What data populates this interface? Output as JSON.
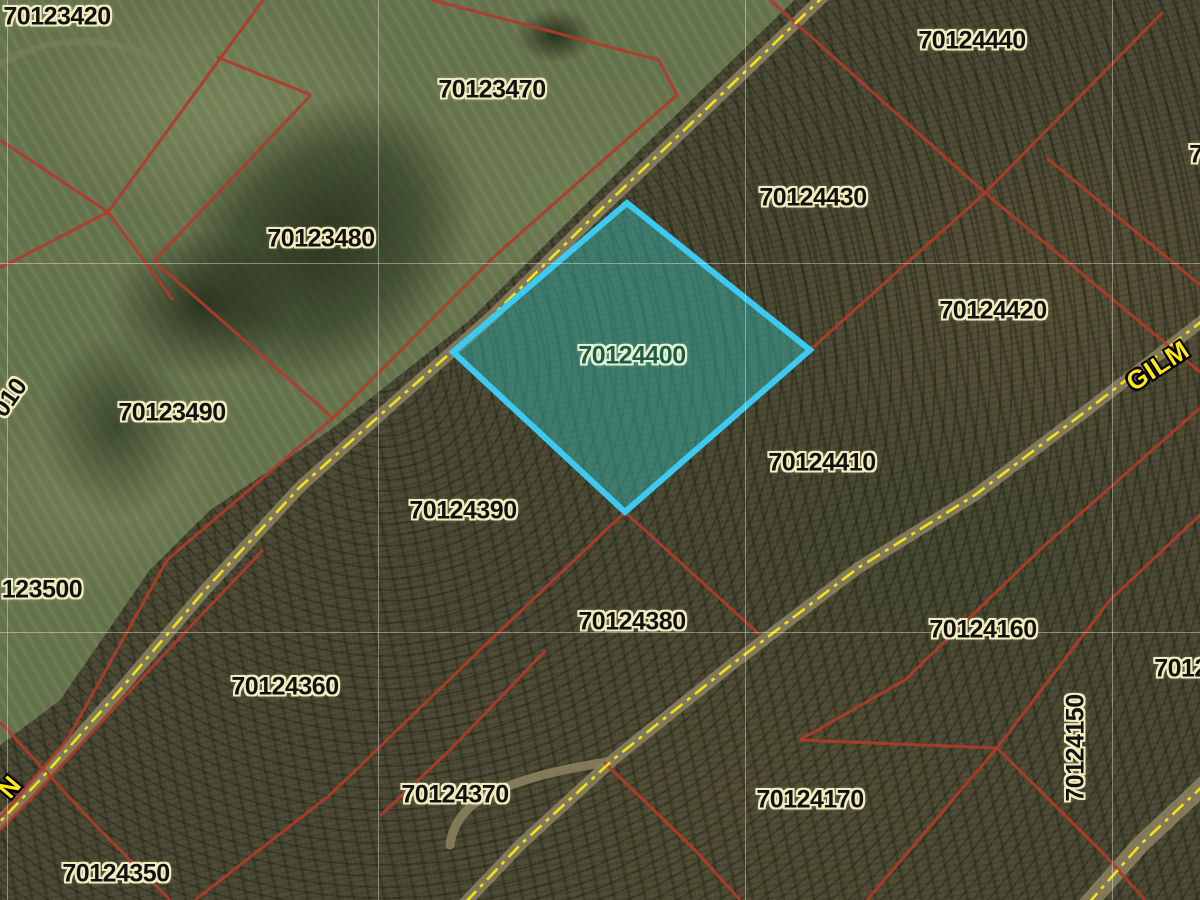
{
  "map": {
    "type": "parcel-gis-aerial-view",
    "selected_parcel_id": "70124400",
    "colors": {
      "parcel_line": "#b03b2a",
      "selected_border": "#3cc9f2",
      "selected_fill": "rgba(52,180,170,0.48)",
      "selected_text": "#1c5c47",
      "road_dash": "#f0e31a",
      "road_text": "#ffe81a",
      "label_text": "#111111",
      "label_halo": "#f2edbe"
    },
    "parcel_labels": [
      {
        "text": "70123420",
        "x": 57,
        "y": 17,
        "rot": 0,
        "style": "default"
      },
      {
        "text": "70123470",
        "x": 492,
        "y": 90,
        "rot": 0,
        "style": "default"
      },
      {
        "text": "70124440",
        "x": 972,
        "y": 41,
        "rot": 0,
        "style": "default"
      },
      {
        "text": "70124430",
        "x": 813,
        "y": 198,
        "rot": 0,
        "style": "default"
      },
      {
        "text": "70123480",
        "x": 321,
        "y": 239,
        "rot": 0,
        "style": "default"
      },
      {
        "text": "70124420",
        "x": 993,
        "y": 311,
        "rot": 0,
        "style": "default"
      },
      {
        "text": "70124400",
        "x": 632,
        "y": 356,
        "rot": 0,
        "style": "selected"
      },
      {
        "text": "70123490",
        "x": 172,
        "y": 413,
        "rot": 0,
        "style": "default"
      },
      {
        "text": "70124410",
        "x": 822,
        "y": 463,
        "rot": 0,
        "style": "default"
      },
      {
        "text": "70124390",
        "x": 463,
        "y": 511,
        "rot": 0,
        "style": "default"
      },
      {
        "text": "123500",
        "x": 42,
        "y": 590,
        "rot": 0,
        "style": "default"
      },
      {
        "text": "70124380",
        "x": 632,
        "y": 622,
        "rot": 0,
        "style": "default"
      },
      {
        "text": "70124160",
        "x": 983,
        "y": 630,
        "rot": 0,
        "style": "default"
      },
      {
        "text": "70124360",
        "x": 285,
        "y": 687,
        "rot": 0,
        "style": "default"
      },
      {
        "text": "70124150",
        "x": 1076,
        "y": 748,
        "rot": -90,
        "style": "default"
      },
      {
        "text": "70124370",
        "x": 455,
        "y": 795,
        "rot": 0,
        "style": "default"
      },
      {
        "text": "70124170",
        "x": 810,
        "y": 800,
        "rot": 0,
        "style": "default"
      },
      {
        "text": "70124350",
        "x": 116,
        "y": 874,
        "rot": 0,
        "style": "default"
      },
      {
        "text": "7012",
        "x": 1181,
        "y": 669,
        "rot": 0,
        "style": "default"
      },
      {
        "text": "7",
        "x": 1196,
        "y": 155,
        "rot": 0,
        "style": "default"
      },
      {
        "text": "010",
        "x": 10,
        "y": 398,
        "rot": -55,
        "style": "default"
      }
    ],
    "road_labels": [
      {
        "text": "GILM",
        "x": 1158,
        "y": 366,
        "rot": -33
      },
      {
        "text": "N",
        "x": 10,
        "y": 787,
        "rot": -50
      }
    ]
  }
}
